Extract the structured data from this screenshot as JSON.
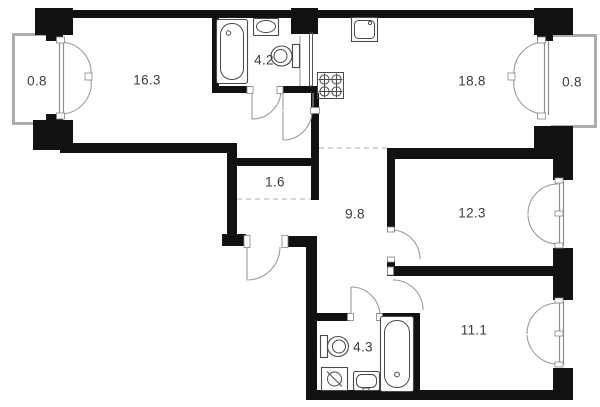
{
  "rooms": [
    {
      "id": "balcony-left",
      "area": "0.8"
    },
    {
      "id": "living-room",
      "area": "16.3"
    },
    {
      "id": "bathroom-top",
      "area": "4.2"
    },
    {
      "id": "kitchen-living",
      "area": "18.8"
    },
    {
      "id": "balcony-right",
      "area": "0.8"
    },
    {
      "id": "storage",
      "area": "1.6"
    },
    {
      "id": "hallway",
      "area": "9.8"
    },
    {
      "id": "bedroom-right",
      "area": "12.3"
    },
    {
      "id": "bathroom-bottom",
      "area": "4.3"
    },
    {
      "id": "bedroom-bottom",
      "area": "11.1"
    }
  ],
  "colors": {
    "wall": "#111111",
    "thin_line": "#9a9a9a",
    "fixture": "#4a4a4a",
    "label": "#3c3c3c",
    "background": "#ffffff"
  }
}
